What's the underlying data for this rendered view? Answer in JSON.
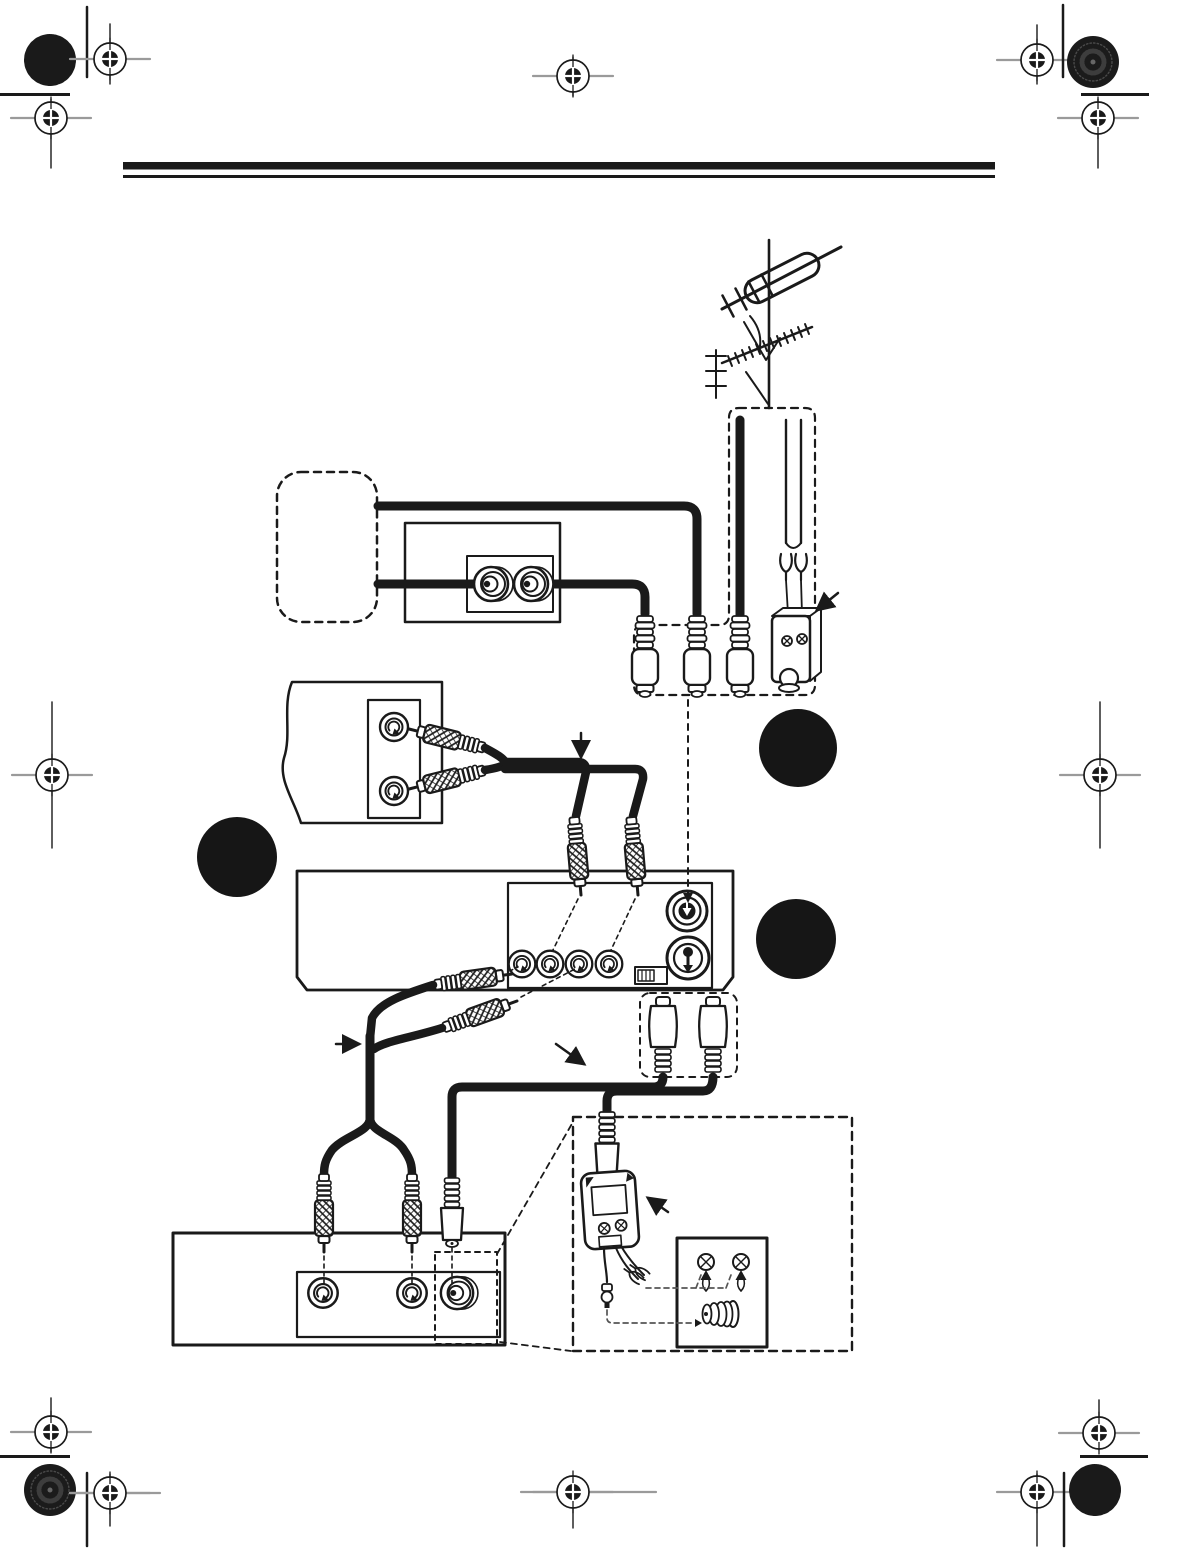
{
  "page": {
    "width": 1187,
    "height": 1568,
    "background": "#ffffff",
    "ink_color": "#1a1a1a",
    "registration_gray": "#9a9a9a"
  },
  "header": {
    "rule": "double-horizontal-rule"
  },
  "printer_marks": {
    "registration_target_count": 12,
    "starburst_mark_count": 2,
    "halftone_dot_count": 2,
    "corner_bar_count": 4,
    "short_rule_count": 4
  },
  "figure": {
    "kind": "vcr-hookup-wiring-diagram",
    "parts": {
      "antenna": "outdoor-vhf-uhf-antenna",
      "antenna_leads": "coax-and-twin-lead-downleads",
      "matching_transformer": "matching-transformer-balun",
      "wall_tv_box": "wall-plate-with-two-coax-jacks",
      "source_device": "audio-video-output-jacks",
      "vcr_panel": "vcr-back-panel",
      "vcr_jacks": "audio-video-in-out-jacks",
      "ant_in_jack": "antenna-in-jack",
      "out_to_tv_jack": "out-to-tv-jack",
      "channel_switch": "ch3-ch4-slide-switch",
      "tv_panel": "tv-back-panel",
      "tv_jacks": "audio-video-in-jacks",
      "tv_ant_jack": "antenna-input-f-jack",
      "detail_inset": "matching-transformer-hookup-detail",
      "screw_terminals": "antenna-screw-terminals",
      "f_connector": "threaded-f-connector"
    },
    "callouts": [
      {
        "shape": "filled-circle"
      },
      {
        "shape": "filled-circle"
      },
      {
        "shape": "filled-circle"
      }
    ],
    "arrow_count": 5
  }
}
